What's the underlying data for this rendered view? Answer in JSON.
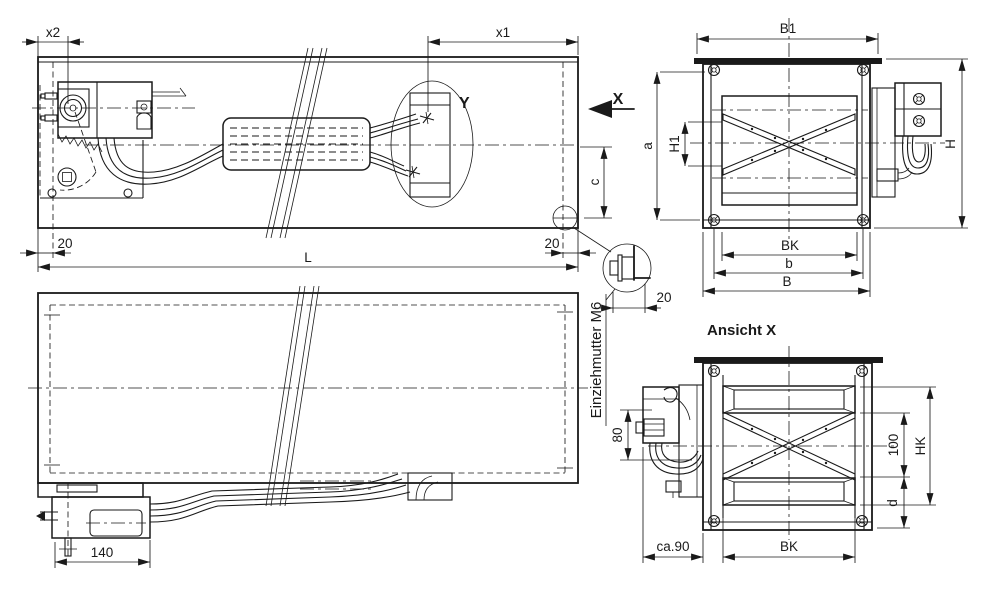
{
  "colors": {
    "ink": "#1a1a1a",
    "paper": "#ffffff"
  },
  "top_view": {
    "dim_x2": "x2",
    "dim_x1": "x1",
    "detail_label": "Y",
    "view_direction_label": "X",
    "dim_c": "c",
    "dim_20_left": "20",
    "dim_20_right": "20",
    "dim_length": "L"
  },
  "nut_detail": {
    "callout": "Einziehmutter M6",
    "dim_20": "20"
  },
  "bottom_view": {
    "dim_140": "140"
  },
  "front_view": {
    "dim_B1": "B1",
    "dim_a": "a",
    "dim_H1": "H1",
    "dim_H": "H",
    "dim_BK": "BK",
    "dim_b": "b",
    "dim_B": "B"
  },
  "view_x": {
    "title": "Ansicht X",
    "dim_80": "80",
    "dim_ca90": "ca.90",
    "dim_BK": "BK",
    "dim_100": "100",
    "dim_HK": "HK",
    "dim_d": "d"
  }
}
